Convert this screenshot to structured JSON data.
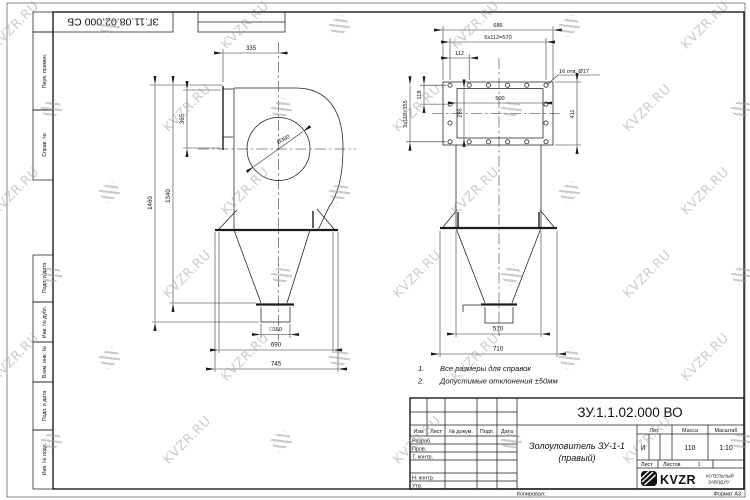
{
  "wm": {
    "text": "KVZR.RU"
  },
  "top_stamp": {
    "doc": "ЗГ.11.08.02.000 СБ"
  },
  "margin": {
    "labels": [
      "Перв. примен.",
      "Справ. №",
      "Подп. и дата",
      "Инв. № дубл.",
      "Взам. инв. №",
      "Подп. и дата",
      "Инв. № подл."
    ]
  },
  "front": {
    "dim_335": "335",
    "dim_365": "365",
    "dim_1340": "1340",
    "dim_1460": "1460",
    "dim_dia": "Ø380",
    "dim_sq": "□160",
    "dim_690": "690",
    "dim_745": "745"
  },
  "side": {
    "dim_686": "686",
    "dim_pitch_h": "5х112=570",
    "dim_112": "112",
    "dim_118": "118",
    "dim_pitch_v": "3х118=355",
    "dim_500": "500",
    "dim_285": "285",
    "dim_411": "411",
    "holes": "16 отв. Ø17",
    "dim_510": "510",
    "dim_710": "710"
  },
  "notes": {
    "n1": "1.",
    "t1": "Все размеры для справок",
    "n2": "2.",
    "t2": "Допустимые отклонения ±50мм"
  },
  "tb": {
    "doc": "ЗУ.1.1.02.000 ВО",
    "name1": "Золоуловитель ЗУ-1-1",
    "name2": "(правый)",
    "h_izm": "Изм",
    "h_list": "Лист",
    "h_doc": "№ докум.",
    "h_podp": "Подп.",
    "h_data": "Дата",
    "r_razrab": "Разраб.",
    "r_prov": "Пров.",
    "r_tkontr": "Т. контр.",
    "r_nkontr": "Н. контр.",
    "r_utv": "Утв.",
    "h_lit": "Лит.",
    "h_mass": "Масса",
    "h_scale": "Масштаб",
    "lit": "И",
    "mass": "110",
    "scale": "1:10",
    "sheet": "Лист",
    "sheets": "Листов",
    "sheets_val": "1",
    "brand": "KVZR",
    "brand_sub1": "КОТЕЛЬНЫЙ",
    "brand_sub2": "ЗАВОД.РУ",
    "copied": "Копировал:",
    "format": "Формат А3"
  }
}
